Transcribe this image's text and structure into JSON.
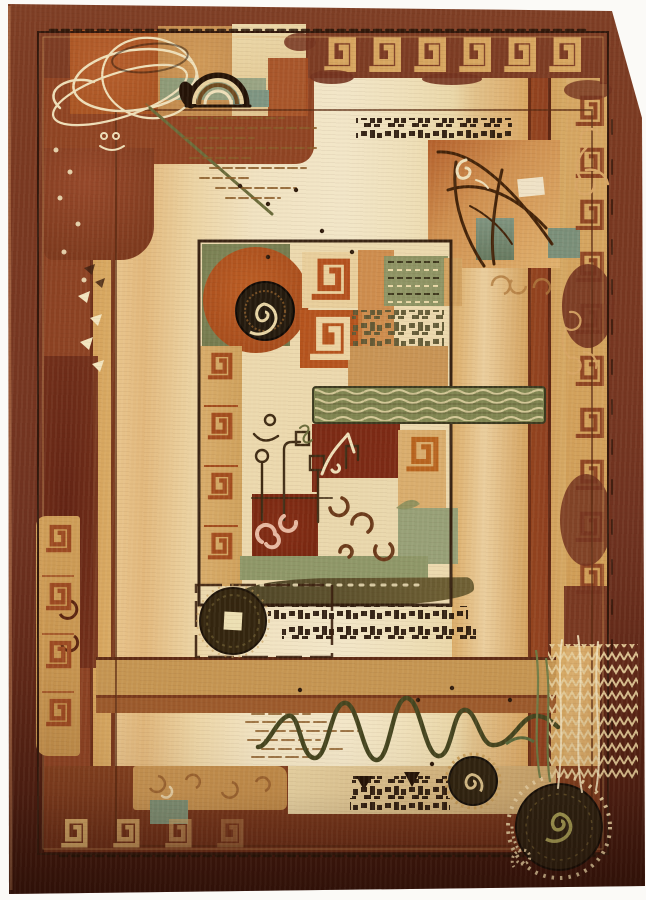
{
  "image": {
    "subject": "Product photo of a contemporary abstract area rug in rust, brown, beige and sage tones, with Greek-key borders, spiral medallions, coin disc, scribbled orbit lines, branch motif, wavy line and glyph marks on a cream field",
    "width_px": 646,
    "height_px": 900
  },
  "palette": {
    "photoBg": "#fbfaf7",
    "borderTop": "#7e3e25",
    "borderMid": "#73331f",
    "borderDark": "#4a1c10",
    "rust": "#8f4423",
    "rustBright": "#a24c22",
    "orange": "#b05a2a",
    "tan": "#c89150",
    "tanBright": "#d8ac6a",
    "tanDeep": "#b07a3e",
    "peach": "#ddb274",
    "cream": "#f0e2bb",
    "creamLine": "#efe0ba",
    "sage": "#8d9a77",
    "teal": "#7e9582",
    "olive": "#7d8456",
    "oliveDark": "#4e4527",
    "greenBar": "#7f8551",
    "oliveLine": "#6a6b3a",
    "inkDark": "#3a1d0e",
    "inkDeep": "#241307",
    "darkRed": "#7c2a15",
    "pink": "#e8b9a2",
    "goldLine": "#d8a666",
    "brownLine": "#8a5b28",
    "spiralDark": "#2c2010",
    "oliveSpiral": "#a8a055",
    "maroon": "#5e2012"
  },
  "motifs": [
    "greek-key border band",
    "spiral medallion",
    "coin disc",
    "orbit scribbles",
    "arch motif",
    "branch motif",
    "scroll ornaments",
    "wavy line",
    "glyph rows",
    "triangle marks",
    "scribble hatch field"
  ]
}
